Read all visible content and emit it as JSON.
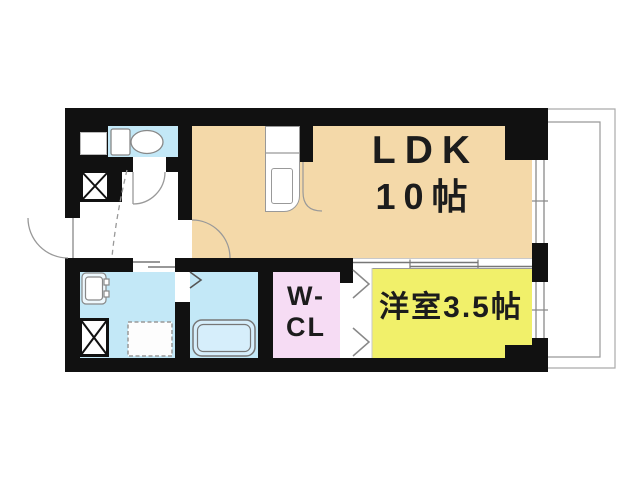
{
  "plan": {
    "title": "apartment-floor-plan",
    "rooms": {
      "ldk": {
        "label_line1": "LDK",
        "label_line2": "10帖",
        "color": "#f4d9a9"
      },
      "western_room": {
        "label": "洋室3.5帖",
        "color": "#f1f06a"
      },
      "walk_in_closet": {
        "label_line1": "W-",
        "label_line2": "CL",
        "color": "#f6dcf4"
      },
      "toilet": {
        "color": "#c3e8f7"
      },
      "washroom": {
        "color": "#c3e8f7"
      },
      "bathroom": {
        "color": "#c3e8f7"
      }
    },
    "colors": {
      "wall": "#111111",
      "linework": "#999999",
      "background": "#ffffff"
    },
    "fixtures": [
      "toilet",
      "kitchen-counter",
      "kitchen-sink",
      "wash-basin",
      "washing-machine-pan",
      "bathtub",
      "pipe-space",
      "pipe-space",
      "entrance-door",
      "toilet-door",
      "ldk-door",
      "bathroom-folding-door",
      "closet-folding-door",
      "sliding-door",
      "window",
      "window",
      "balcony"
    ]
  }
}
